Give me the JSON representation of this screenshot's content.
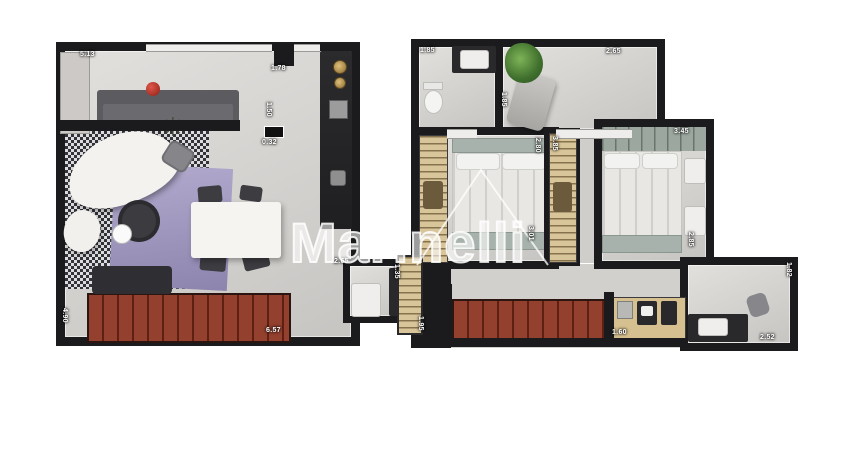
{
  "watermark": {
    "text": "Marinelli"
  },
  "icons": {
    "plant": "✳"
  },
  "colors": {
    "wall": "#1b1b1d",
    "deck_plank": "#8e3c2b",
    "rug": "#a49cc2",
    "wardrobe_wood": "#d8c59a",
    "headboard_teal": "#a6b2ab",
    "accent_red": "#c23b2e"
  },
  "plan_lower": {
    "dims": {
      "top_width": "5.13",
      "door_top": "1.78",
      "passage_width": "0.32",
      "passage_height": "1.50",
      "left_height": "4.90",
      "bottom_width": "6.57",
      "wc_width": "2.65",
      "wc_depth": "1.35"
    }
  },
  "plan_upper": {
    "dims": {
      "bath_width": "1.85",
      "wardrobe_room_width": "2.65",
      "wardrobe_room_depth": "1.85",
      "bedroom1_width": "2.80",
      "closet_depth": "3.85",
      "bedroom1_depth": "3.01",
      "bedroom2_width": "3.45",
      "bedroom2_depth": "2.85",
      "balcony_depth": "1.95",
      "laundry_width": "1.60",
      "office_depth": "1.82",
      "office_width": "2.52"
    }
  }
}
